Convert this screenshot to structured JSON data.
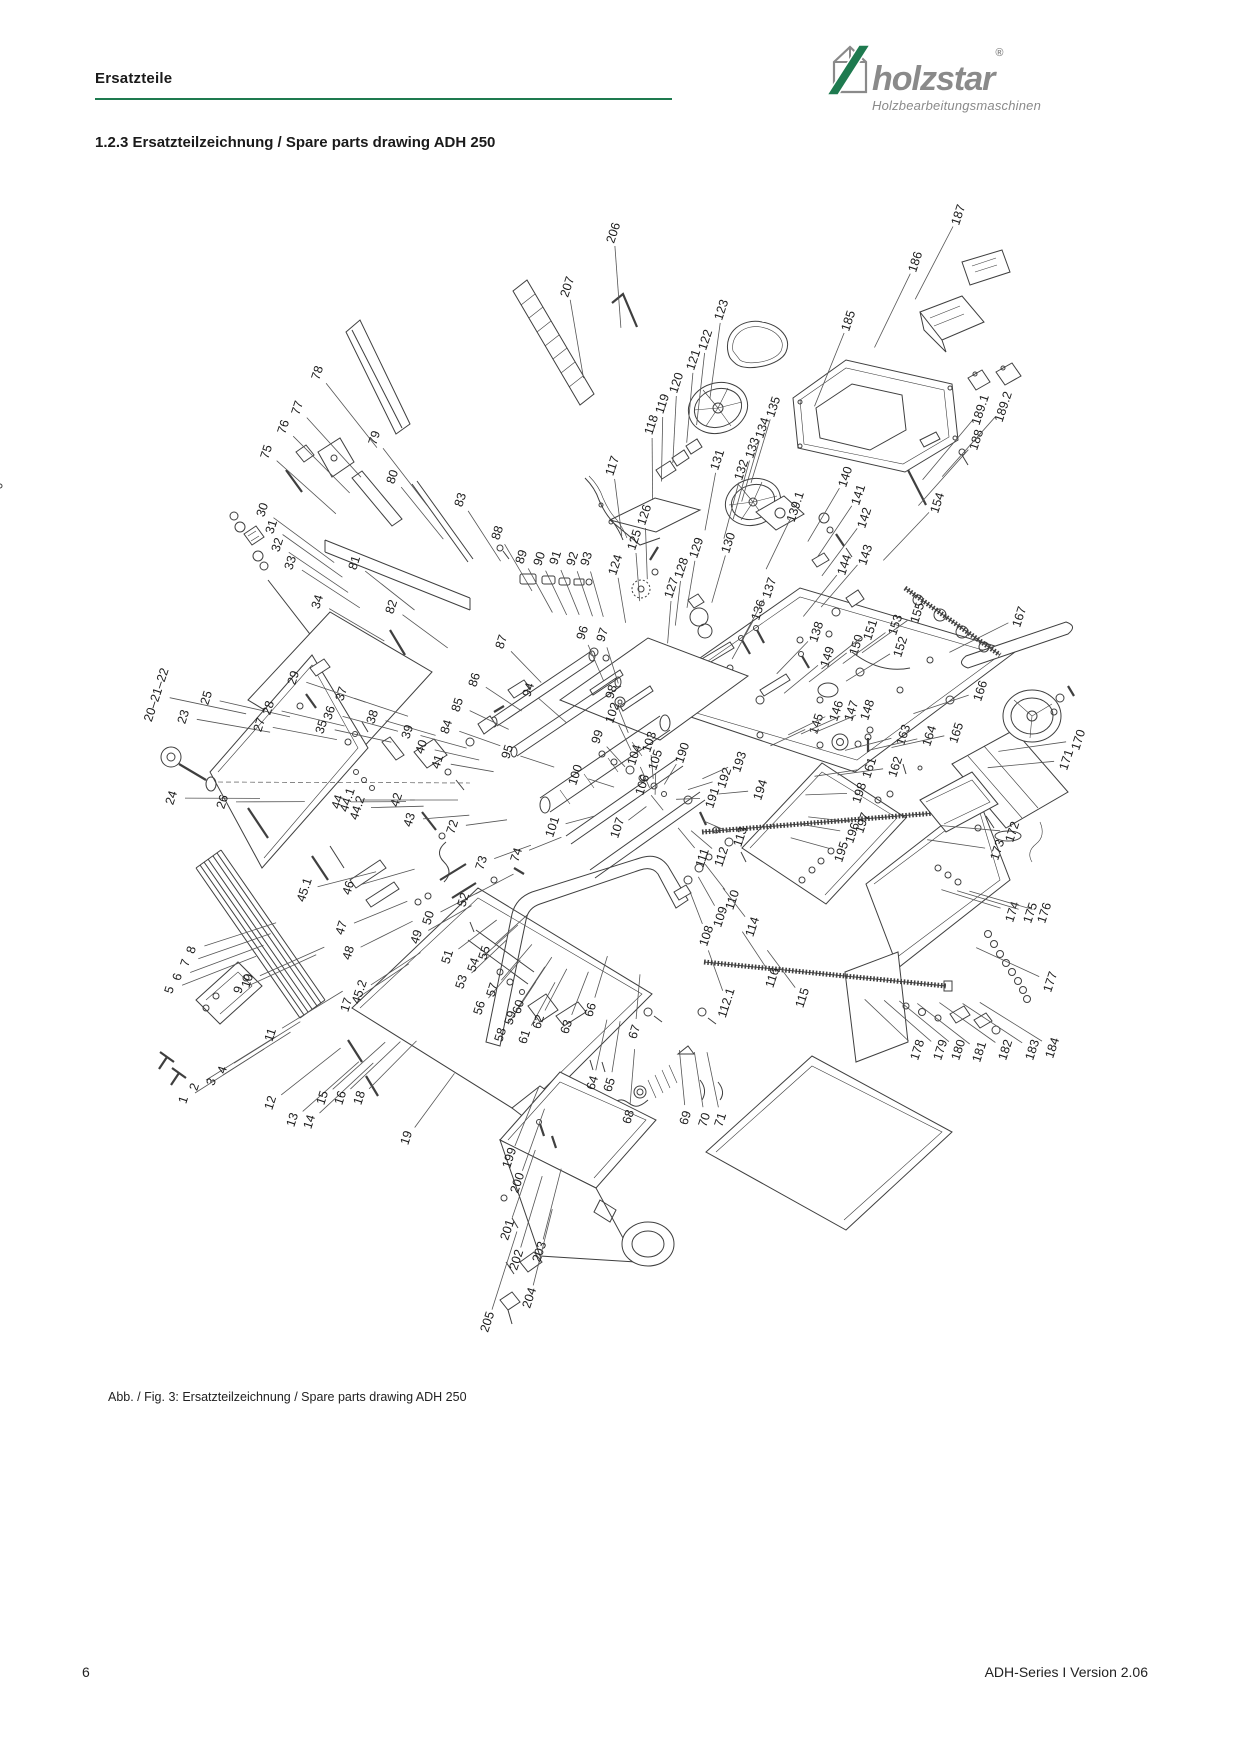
{
  "colors": {
    "accent_green": "#1e7a4f",
    "brand_gray": "#8a8a8a",
    "line_art": "#3f3f3f"
  },
  "header": {
    "section_label": "Ersatzteile"
  },
  "logo": {
    "brand": "holzstar",
    "registered": "®",
    "tagline": "Holzbearbeitungsmaschinen",
    "mark": "house-with-green-slash-icon"
  },
  "title": {
    "text": "1.2.3 Ersatzteilzeichnung / Spare parts drawing ADH 250"
  },
  "figure": {
    "caption": "Abb. / Fig. 3: Ersatzteilzeichnung / Spare parts drawing ADH 250",
    "part_labels": [
      {
        "n": "1",
        "x": 184,
        "y": 1100
      },
      {
        "n": "2",
        "x": 195,
        "y": 1087
      },
      {
        "n": "3",
        "x": 212,
        "y": 1082
      },
      {
        "n": "4",
        "x": 223,
        "y": 1070
      },
      {
        "n": "5",
        "x": 170,
        "y": 990
      },
      {
        "n": "6",
        "x": 178,
        "y": 977
      },
      {
        "n": "7",
        "x": 186,
        "y": 963
      },
      {
        "n": "8",
        "x": 192,
        "y": 950
      },
      {
        "n": "9",
        "x": 239,
        "y": 990
      },
      {
        "n": "10",
        "x": 248,
        "y": 981
      },
      {
        "n": "11",
        "x": 271,
        "y": 1035
      },
      {
        "n": "12",
        "x": 271,
        "y": 1103
      },
      {
        "n": "13",
        "x": 293,
        "y": 1120
      },
      {
        "n": "14",
        "x": 310,
        "y": 1122
      },
      {
        "n": "15",
        "x": 323,
        "y": 1098
      },
      {
        "n": "16",
        "x": 341,
        "y": 1098
      },
      {
        "n": "17",
        "x": 347,
        "y": 1005
      },
      {
        "n": "18",
        "x": 360,
        "y": 1098
      },
      {
        "n": "19",
        "x": 407,
        "y": 1138
      },
      {
        "n": "20–21–22",
        "x": 157,
        "y": 695
      },
      {
        "n": "23",
        "x": 184,
        "y": 717
      },
      {
        "n": "24",
        "x": 172,
        "y": 798
      },
      {
        "n": "25",
        "x": 207,
        "y": 698
      },
      {
        "n": "26",
        "x": 223,
        "y": 802
      },
      {
        "n": "27",
        "x": 260,
        "y": 725
      },
      {
        "n": "28",
        "x": 269,
        "y": 708
      },
      {
        "n": "29",
        "x": 294,
        "y": 678
      },
      {
        "n": "30",
        "x": 263,
        "y": 510
      },
      {
        "n": "31",
        "x": 272,
        "y": 527
      },
      {
        "n": "32",
        "x": 278,
        "y": 545
      },
      {
        "n": "33",
        "x": 291,
        "y": 563
      },
      {
        "n": "34",
        "x": 318,
        "y": 602
      },
      {
        "n": "35",
        "x": 322,
        "y": 727
      },
      {
        "n": "36",
        "x": 330,
        "y": 713
      },
      {
        "n": "37",
        "x": 342,
        "y": 694
      },
      {
        "n": "38",
        "x": 373,
        "y": 717
      },
      {
        "n": "39",
        "x": 408,
        "y": 732
      },
      {
        "n": "40",
        "x": 422,
        "y": 747
      },
      {
        "n": "41",
        "x": 438,
        "y": 762
      },
      {
        "n": "42",
        "x": 397,
        "y": 800
      },
      {
        "n": "43",
        "x": 410,
        "y": 820
      },
      {
        "n": "44",
        "x": 338,
        "y": 802
      },
      {
        "n": "44.1",
        "x": 348,
        "y": 800
      },
      {
        "n": "44.2",
        "x": 358,
        "y": 808
      },
      {
        "n": "45.1",
        "x": 305,
        "y": 890
      },
      {
        "n": "45.2",
        "x": 360,
        "y": 992
      },
      {
        "n": "46",
        "x": 349,
        "y": 888
      },
      {
        "n": "47",
        "x": 342,
        "y": 928
      },
      {
        "n": "48",
        "x": 349,
        "y": 953
      },
      {
        "n": "49",
        "x": 417,
        "y": 937
      },
      {
        "n": "50",
        "x": 429,
        "y": 918
      },
      {
        "n": "51",
        "x": 448,
        "y": 957
      },
      {
        "n": "52",
        "x": 464,
        "y": 900
      },
      {
        "n": "53",
        "x": 462,
        "y": 982
      },
      {
        "n": "54",
        "x": 474,
        "y": 965
      },
      {
        "n": "55",
        "x": 485,
        "y": 953
      },
      {
        "n": "56",
        "x": 480,
        "y": 1008
      },
      {
        "n": "57",
        "x": 493,
        "y": 990
      },
      {
        "n": "58",
        "x": 501,
        "y": 1035
      },
      {
        "n": "59",
        "x": 511,
        "y": 1018
      },
      {
        "n": "60",
        "x": 519,
        "y": 1007
      },
      {
        "n": "61",
        "x": 525,
        "y": 1037
      },
      {
        "n": "62",
        "x": 539,
        "y": 1022
      },
      {
        "n": "63",
        "x": 567,
        "y": 1027
      },
      {
        "n": "64",
        "x": 593,
        "y": 1083
      },
      {
        "n": "65",
        "x": 610,
        "y": 1085
      },
      {
        "n": "66",
        "x": 591,
        "y": 1010
      },
      {
        "n": "67",
        "x": 635,
        "y": 1032
      },
      {
        "n": "68",
        "x": 629,
        "y": 1117
      },
      {
        "n": "69",
        "x": 686,
        "y": 1118
      },
      {
        "n": "70",
        "x": 705,
        "y": 1120
      },
      {
        "n": "71",
        "x": 721,
        "y": 1120
      },
      {
        "n": "72",
        "x": 453,
        "y": 827
      },
      {
        "n": "73",
        "x": 482,
        "y": 863
      },
      {
        "n": "74",
        "x": 517,
        "y": 855
      },
      {
        "n": "75",
        "x": 267,
        "y": 452
      },
      {
        "n": "76",
        "x": 284,
        "y": 427
      },
      {
        "n": "77",
        "x": 298,
        "y": 408
      },
      {
        "n": "78",
        "x": 318,
        "y": 373
      },
      {
        "n": "79",
        "x": 375,
        "y": 438
      },
      {
        "n": "80",
        "x": 393,
        "y": 477
      },
      {
        "n": "81",
        "x": 355,
        "y": 563
      },
      {
        "n": "82",
        "x": 392,
        "y": 607
      },
      {
        "n": "83",
        "x": 461,
        "y": 500
      },
      {
        "n": "84",
        "x": 447,
        "y": 727
      },
      {
        "n": "85",
        "x": 458,
        "y": 705
      },
      {
        "n": "86",
        "x": 475,
        "y": 680
      },
      {
        "n": "87",
        "x": 502,
        "y": 642
      },
      {
        "n": "88",
        "x": 498,
        "y": 533
      },
      {
        "n": "89",
        "x": 522,
        "y": 557
      },
      {
        "n": "90",
        "x": 540,
        "y": 559
      },
      {
        "n": "91",
        "x": 556,
        "y": 558
      },
      {
        "n": "92",
        "x": 573,
        "y": 559
      },
      {
        "n": "93",
        "x": 587,
        "y": 559
      },
      {
        "n": "94",
        "x": 529,
        "y": 690
      },
      {
        "n": "95",
        "x": 508,
        "y": 752
      },
      {
        "n": "96",
        "x": 583,
        "y": 633
      },
      {
        "n": "97",
        "x": 603,
        "y": 635
      },
      {
        "n": "98",
        "x": 612,
        "y": 692
      },
      {
        "n": "99",
        "x": 598,
        "y": 737
      },
      {
        "n": "100",
        "x": 576,
        "y": 775
      },
      {
        "n": "101",
        "x": 553,
        "y": 827
      },
      {
        "n": "102",
        "x": 613,
        "y": 713
      },
      {
        "n": "103",
        "x": 650,
        "y": 742
      },
      {
        "n": "104",
        "x": 635,
        "y": 755
      },
      {
        "n": "105",
        "x": 656,
        "y": 760
      },
      {
        "n": "106",
        "x": 643,
        "y": 785
      },
      {
        "n": "107",
        "x": 618,
        "y": 828
      },
      {
        "n": "108",
        "x": 707,
        "y": 936
      },
      {
        "n": "109",
        "x": 721,
        "y": 917
      },
      {
        "n": "110",
        "x": 733,
        "y": 900
      },
      {
        "n": "111",
        "x": 703,
        "y": 858
      },
      {
        "n": "112",
        "x": 722,
        "y": 857
      },
      {
        "n": "112.1",
        "x": 727,
        "y": 1003
      },
      {
        "n": "113",
        "x": 741,
        "y": 837
      },
      {
        "n": "114",
        "x": 753,
        "y": 927
      },
      {
        "n": "115",
        "x": 803,
        "y": 998
      },
      {
        "n": "116",
        "x": 773,
        "y": 978
      },
      {
        "n": "117",
        "x": 613,
        "y": 466
      },
      {
        "n": "118",
        "x": 652,
        "y": 425
      },
      {
        "n": "119",
        "x": 663,
        "y": 404
      },
      {
        "n": "120",
        "x": 677,
        "y": 383
      },
      {
        "n": "121",
        "x": 694,
        "y": 360
      },
      {
        "n": "122",
        "x": 706,
        "y": 340
      },
      {
        "n": "123",
        "x": 722,
        "y": 310
      },
      {
        "n": "124",
        "x": 616,
        "y": 565
      },
      {
        "n": "125",
        "x": 635,
        "y": 540
      },
      {
        "n": "126",
        "x": 645,
        "y": 515
      },
      {
        "n": "127",
        "x": 672,
        "y": 588
      },
      {
        "n": "128",
        "x": 682,
        "y": 568
      },
      {
        "n": "129",
        "x": 697,
        "y": 548
      },
      {
        "n": "130",
        "x": 729,
        "y": 543
      },
      {
        "n": "131",
        "x": 718,
        "y": 460
      },
      {
        "n": "132",
        "x": 742,
        "y": 470
      },
      {
        "n": "133",
        "x": 753,
        "y": 448
      },
      {
        "n": "134",
        "x": 763,
        "y": 428
      },
      {
        "n": "135",
        "x": 774,
        "y": 407
      },
      {
        "n": "136",
        "x": 759,
        "y": 610
      },
      {
        "n": "137",
        "x": 770,
        "y": 588
      },
      {
        "n": "138",
        "x": 817,
        "y": 632
      },
      {
        "n": "139.1",
        "x": 796,
        "y": 507
      },
      {
        "n": "140",
        "x": 846,
        "y": 477
      },
      {
        "n": "141",
        "x": 859,
        "y": 495
      },
      {
        "n": "142",
        "x": 865,
        "y": 518
      },
      {
        "n": "143",
        "x": 866,
        "y": 555
      },
      {
        "n": "144",
        "x": 845,
        "y": 565
      },
      {
        "n": "145",
        "x": 817,
        "y": 724
      },
      {
        "n": "146",
        "x": 837,
        "y": 711
      },
      {
        "n": "147",
        "x": 852,
        "y": 711
      },
      {
        "n": "148",
        "x": 868,
        "y": 710
      },
      {
        "n": "149",
        "x": 828,
        "y": 657
      },
      {
        "n": "150",
        "x": 857,
        "y": 645
      },
      {
        "n": "151",
        "x": 871,
        "y": 630
      },
      {
        "n": "152",
        "x": 901,
        "y": 647
      },
      {
        "n": "153",
        "x": 896,
        "y": 625
      },
      {
        "n": "154",
        "x": 938,
        "y": 503
      },
      {
        "n": "155",
        "x": 918,
        "y": 613
      },
      {
        "n": "161",
        "x": 870,
        "y": 768
      },
      {
        "n": "162",
        "x": 896,
        "y": 767
      },
      {
        "n": "163",
        "x": 904,
        "y": 735
      },
      {
        "n": "164",
        "x": 930,
        "y": 736
      },
      {
        "n": "165",
        "x": 957,
        "y": 733
      },
      {
        "n": "166",
        "x": 981,
        "y": 691
      },
      {
        "n": "167",
        "x": 1020,
        "y": 617
      },
      {
        "n": "170",
        "x": 1079,
        "y": 740
      },
      {
        "n": "171",
        "x": 1067,
        "y": 760
      },
      {
        "n": "172",
        "x": 1013,
        "y": 832
      },
      {
        "n": "173",
        "x": 998,
        "y": 850
      },
      {
        "n": "174",
        "x": 1013,
        "y": 912
      },
      {
        "n": "175",
        "x": 1031,
        "y": 913
      },
      {
        "n": "176",
        "x": 1045,
        "y": 913
      },
      {
        "n": "177",
        "x": 1051,
        "y": 982
      },
      {
        "n": "178",
        "x": 918,
        "y": 1050
      },
      {
        "n": "179",
        "x": 941,
        "y": 1050
      },
      {
        "n": "180",
        "x": 959,
        "y": 1050
      },
      {
        "n": "181",
        "x": 980,
        "y": 1052
      },
      {
        "n": "182",
        "x": 1006,
        "y": 1050
      },
      {
        "n": "183",
        "x": 1033,
        "y": 1050
      },
      {
        "n": "184",
        "x": 1053,
        "y": 1048
      },
      {
        "n": "185",
        "x": 849,
        "y": 321
      },
      {
        "n": "186",
        "x": 916,
        "y": 262
      },
      {
        "n": "187",
        "x": 959,
        "y": 215
      },
      {
        "n": "188",
        "x": 977,
        "y": 440
      },
      {
        "n": "189.1",
        "x": 981,
        "y": 410
      },
      {
        "n": "189.2",
        "x": 1004,
        "y": 407
      },
      {
        "n": "190",
        "x": 683,
        "y": 753
      },
      {
        "n": "191",
        "x": 713,
        "y": 798
      },
      {
        "n": "192",
        "x": 725,
        "y": 778
      },
      {
        "n": "193",
        "x": 740,
        "y": 762
      },
      {
        "n": "194",
        "x": 761,
        "y": 790
      },
      {
        "n": "195",
        "x": 842,
        "y": 852
      },
      {
        "n": "196",
        "x": 853,
        "y": 833
      },
      {
        "n": "197",
        "x": 863,
        "y": 823
      },
      {
        "n": "198",
        "x": 860,
        "y": 793
      },
      {
        "n": "199",
        "x": 510,
        "y": 1158
      },
      {
        "n": "200",
        "x": 518,
        "y": 1183
      },
      {
        "n": "201",
        "x": 508,
        "y": 1230
      },
      {
        "n": "202",
        "x": 517,
        "y": 1260
      },
      {
        "n": "203",
        "x": 540,
        "y": 1252
      },
      {
        "n": "204",
        "x": 530,
        "y": 1298
      },
      {
        "n": "205",
        "x": 488,
        "y": 1322
      },
      {
        "n": "206",
        "x": 614,
        "y": 233
      },
      {
        "n": "207",
        "x": 568,
        "y": 287
      }
    ]
  },
  "footer": {
    "page_number": "6",
    "version": "ADH-Series I Version 2.06"
  }
}
